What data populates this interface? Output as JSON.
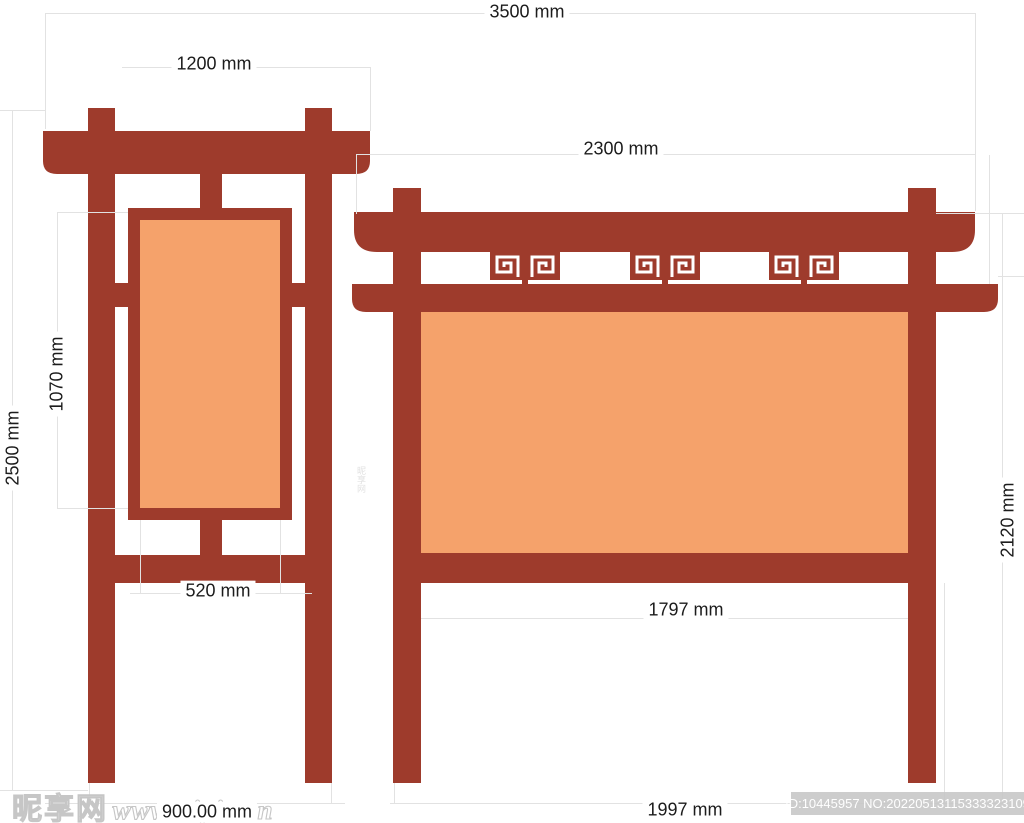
{
  "drawing": {
    "dimensions": {
      "total_width": "3500 mm",
      "left_roof_width": "1200 mm",
      "right_roof_width": "2300 mm",
      "overall_height": "2500 mm",
      "left_panel_height": "1070 mm",
      "left_panel_width": "520 mm",
      "left_base_width": "900.00 mm",
      "right_panel_width": "1797 mm",
      "right_base_width": "1997 mm",
      "right_height": "2120 mm"
    },
    "colors": {
      "frame": "#9E3B2C",
      "panel": "#F5A26B",
      "dim_line": "#E2E2E2",
      "dim_text": "#1C1C1C"
    }
  },
  "watermark": {
    "site_name": "昵享网",
    "site_url": "www.nipic.cn",
    "image_id": "ID:10445957 NO:20220513115333323109"
  }
}
